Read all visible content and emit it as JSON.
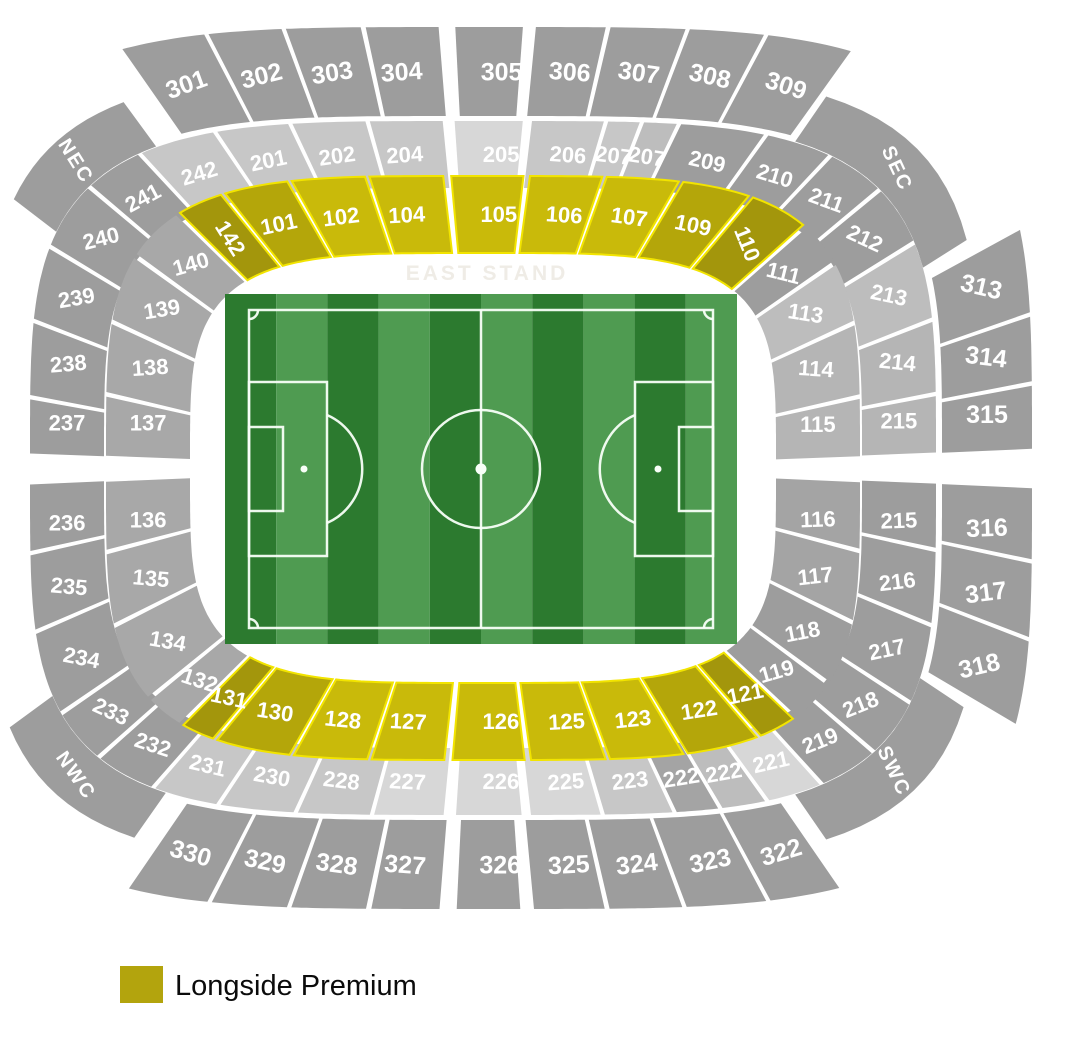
{
  "legend": {
    "label": "Longside Premium",
    "swatch": "#b3a40d"
  },
  "stand_label": "EAST STAND",
  "palette": {
    "Y1": "#c9ba0a",
    "Y2": "#b4a60a",
    "Y3": "#a3960c",
    "G": "#9d9d9d",
    "G2": "#a4a4a4",
    "L": "#c7c7c7",
    "LL": "#d7d7d7",
    "M": "#b5b5b5",
    "M2": "#a8a8a8",
    "M3": "#bdbdbd",
    "yellow_stroke": "#f2e400"
  },
  "pitch": {
    "x": 225,
    "y": 294,
    "w": 512,
    "h": 350,
    "stripes": 10,
    "stripe_dark": "#2c7a2f",
    "stripe_light": "#4f9b51",
    "line_color": "#f8fff8"
  },
  "sections": [
    {
      "label": "301",
      "ring": "r3",
      "color": "G",
      "rot": -20,
      "f": {
        "x": 150,
        "s": -1
      },
      "t": {
        "x": 229,
        "s": -1
      }
    },
    {
      "label": "302",
      "ring": "r3",
      "color": "G",
      "rot": -14,
      "t": {
        "x": 300,
        "s": -1
      }
    },
    {
      "label": "303",
      "ring": "r3",
      "color": "G",
      "rot": -9,
      "t": {
        "x": 373,
        "s": -1
      }
    },
    {
      "label": "304",
      "ring": "r3",
      "color": "G",
      "rot": -4,
      "t": {
        "x": 449,
        "s": -1
      }
    },
    {
      "label": "305",
      "ring": "r3",
      "color": "G",
      "rot": 0,
      "t": {
        "x": 526,
        "s": -1
      }
    },
    {
      "label": "306",
      "ring": "r3",
      "color": "G",
      "rot": 4,
      "t": {
        "x": 598,
        "s": -1
      }
    },
    {
      "label": "307",
      "ring": "r3",
      "color": "G",
      "rot": 8,
      "t": {
        "x": 671,
        "s": -1
      }
    },
    {
      "label": "308",
      "ring": "r3",
      "color": "G",
      "rot": 13,
      "t": {
        "x": 743,
        "s": -1
      }
    },
    {
      "label": "309",
      "ring": "r3",
      "color": "G",
      "rot": 18,
      "t": {
        "deg": -63
      }
    },
    {
      "label": "313",
      "ring": "r3",
      "color": "G",
      "rot": 13,
      "f": {
        "y": 252,
        "s": 1
      },
      "t": {
        "y": 330,
        "s": 1
      }
    },
    {
      "label": "314",
      "ring": "r3",
      "color": "G",
      "rot": 7,
      "t": {
        "y": 392,
        "s": 1
      }
    },
    {
      "label": "315",
      "ring": "r3",
      "color": "G",
      "rot": 0,
      "t": {
        "y": 472,
        "s": 1
      }
    },
    {
      "label": "316",
      "ring": "r3",
      "color": "G",
      "rot": -2,
      "t": {
        "y": 552,
        "s": 1
      }
    },
    {
      "label": "317",
      "ring": "r3",
      "color": "G",
      "rot": -7,
      "t": {
        "y": 622,
        "s": 1
      }
    },
    {
      "label": "318",
      "ring": "r3",
      "color": "G",
      "rot": -13,
      "t": {
        "y": 700,
        "s": 1
      }
    },
    {
      "label": "322",
      "ring": "r3",
      "color": "G",
      "rot": -17,
      "f": {
        "x": 812,
        "s": 1
      },
      "t": {
        "x": 745,
        "s": 1
      }
    },
    {
      "label": "323",
      "ring": "r3",
      "color": "G",
      "rot": -12,
      "t": {
        "x": 668,
        "s": 1
      }
    },
    {
      "label": "324",
      "ring": "r3",
      "color": "G",
      "rot": -7,
      "t": {
        "x": 597,
        "s": 1
      }
    },
    {
      "label": "325",
      "ring": "r3",
      "color": "G",
      "rot": -3,
      "t": {
        "x": 524,
        "s": 1
      }
    },
    {
      "label": "326",
      "ring": "r3",
      "color": "G",
      "rot": 0,
      "t": {
        "x": 450,
        "s": 1
      }
    },
    {
      "label": "327",
      "ring": "r3",
      "color": "G",
      "rot": 4,
      "t": {
        "x": 378,
        "s": 1
      }
    },
    {
      "label": "328",
      "ring": "r3",
      "color": "G",
      "rot": 8,
      "t": {
        "x": 305,
        "s": 1
      }
    },
    {
      "label": "329",
      "ring": "r3",
      "color": "G",
      "rot": 12,
      "t": {
        "x": 232,
        "s": 1
      }
    },
    {
      "label": "330",
      "ring": "r3",
      "color": "G",
      "rot": 16,
      "t": {
        "x": 156,
        "s": 1
      }
    },
    {
      "label": "NEC",
      "ring": "cn",
      "color": "G",
      "rot": 58,
      "corner": true,
      "f": {
        "deg": -153
      },
      "t": {
        "deg": -121
      }
    },
    {
      "label": "SEC",
      "ring": "cn",
      "color": "G",
      "rot": 65,
      "corner": true,
      "f": {
        "deg": -62
      },
      "t": {
        "deg": -19
      }
    },
    {
      "label": "SWC",
      "ring": "cn",
      "color": "G",
      "rot": 65,
      "corner": true,
      "f": {
        "deg": 21
      },
      "t": {
        "deg": 62
      }
    },
    {
      "label": "NWC",
      "ring": "cn",
      "color": "G",
      "rot": 55,
      "corner": true,
      "f": {
        "deg": 119
      },
      "t": {
        "deg": 155
      }
    },
    {
      "label": "242",
      "ring": "r2",
      "color": "L",
      "rot": -17,
      "f": {
        "deg": -125
      },
      "t": {
        "x": 237,
        "s": -1
      }
    },
    {
      "label": "201",
      "ring": "r2",
      "color": "L",
      "rot": -12,
      "t": {
        "x": 306,
        "s": -1
      }
    },
    {
      "label": "202",
      "ring": "r2",
      "color": "L",
      "rot": -8,
      "t": {
        "x": 377,
        "s": -1
      }
    },
    {
      "label": "204",
      "ring": "r2",
      "color": "L",
      "rot": -4,
      "t": {
        "x": 451,
        "s": -1
      }
    },
    {
      "label": "205",
      "ring": "r2",
      "color": "LL",
      "rot": 0,
      "t": {
        "x": 524,
        "s": -1
      }
    },
    {
      "label": "206",
      "ring": "r2",
      "color": "L",
      "rot": 4,
      "t": {
        "x": 596,
        "s": -1
      }
    },
    {
      "label": "207",
      "ring": "r2",
      "color": "L",
      "rot": 7,
      "t": {
        "x": 629,
        "s": -1
      }
    },
    {
      "label": "207",
      "ring": "r2",
      "color": "M3",
      "rot": 9,
      "t": {
        "x": 663,
        "s": -1
      }
    },
    {
      "label": "209",
      "ring": "r2",
      "color": "G",
      "rot": 13,
      "t": {
        "deg": -67
      }
    },
    {
      "label": "210",
      "ring": "r2",
      "color": "G",
      "rot": 17,
      "t": {
        "deg": -54
      }
    },
    {
      "label": "211",
      "ring": "r2",
      "color": "G",
      "rot": 20,
      "t": {
        "deg": -40
      }
    },
    {
      "label": "212",
      "ring": "r2",
      "color": "G",
      "rot": 25,
      "t": {
        "deg": -25
      }
    },
    {
      "label": "213",
      "ring": "r2",
      "color": "M3",
      "rot": 12,
      "t": {
        "y": 334,
        "s": 1
      }
    },
    {
      "label": "214",
      "ring": "r2",
      "color": "M",
      "rot": 6,
      "t": {
        "y": 401,
        "s": 1
      }
    },
    {
      "label": "215",
      "ring": "r2",
      "color": "M",
      "rot": 0,
      "t": {
        "y": 469,
        "s": 1
      }
    },
    {
      "label": "215",
      "ring": "r2",
      "color": "G",
      "rot": -2,
      "t": {
        "y": 542,
        "s": 1
      }
    },
    {
      "label": "216",
      "ring": "r2",
      "color": "G",
      "rot": -7,
      "t": {
        "y": 610,
        "s": 1
      }
    },
    {
      "label": "217",
      "ring": "r2",
      "color": "G",
      "rot": -12,
      "t": {
        "y": 680,
        "s": 1
      }
    },
    {
      "label": "218",
      "ring": "r2",
      "color": "G",
      "rot": -22,
      "t": {
        "deg": 42
      }
    },
    {
      "label": "219",
      "ring": "r2",
      "color": "G",
      "rot": -22,
      "t": {
        "deg": 56
      }
    },
    {
      "label": "221",
      "ring": "r2",
      "color": "LL",
      "rot": -13,
      "t": {
        "x": 744,
        "s": 1
      }
    },
    {
      "label": "222",
      "ring": "r2",
      "color": "M3",
      "rot": -10,
      "t": {
        "x": 701,
        "s": 1
      }
    },
    {
      "label": "222",
      "ring": "r2",
      "color": "G2",
      "rot": -9,
      "t": {
        "x": 659,
        "s": 1
      }
    },
    {
      "label": "223",
      "ring": "r2",
      "color": "L",
      "rot": -7,
      "t": {
        "x": 593,
        "s": 1
      }
    },
    {
      "label": "225",
      "ring": "r2",
      "color": "LL",
      "rot": -4,
      "t": {
        "x": 523,
        "s": 1
      }
    },
    {
      "label": "226",
      "ring": "r2",
      "color": "LL",
      "rot": 0,
      "t": {
        "x": 452,
        "s": 1
      }
    },
    {
      "label": "227",
      "ring": "r2",
      "color": "LL",
      "rot": 3,
      "t": {
        "x": 381,
        "s": 1
      }
    },
    {
      "label": "228",
      "ring": "r2",
      "color": "L",
      "rot": 7,
      "t": {
        "x": 311,
        "s": 1
      }
    },
    {
      "label": "230",
      "ring": "r2",
      "color": "L",
      "rot": 10,
      "t": {
        "x": 240,
        "s": 1
      }
    },
    {
      "label": "231",
      "ring": "r2",
      "color": "L",
      "rot": 13,
      "t": {
        "deg": 122
      }
    },
    {
      "label": "232",
      "ring": "r2",
      "color": "G",
      "rot": 18,
      "t": {
        "deg": 136
      }
    },
    {
      "label": "233",
      "ring": "r2",
      "color": "G",
      "rot": 25,
      "t": {
        "deg": 150
      }
    },
    {
      "label": "234",
      "ring": "r2",
      "color": "G",
      "rot": 11,
      "t": {
        "y": 616,
        "s": -1
      }
    },
    {
      "label": "235",
      "ring": "r2",
      "color": "G",
      "rot": 5,
      "t": {
        "y": 545,
        "s": -1
      }
    },
    {
      "label": "236",
      "ring": "r2",
      "color": "G",
      "rot": 0,
      "t": {
        "y": 473,
        "s": -1
      }
    },
    {
      "label": "237",
      "ring": "r2",
      "color": "G",
      "rot": 0,
      "t": {
        "y": 404,
        "s": -1
      }
    },
    {
      "label": "238",
      "ring": "r2",
      "color": "G",
      "rot": -5,
      "t": {
        "y": 335,
        "s": -1
      }
    },
    {
      "label": "239",
      "ring": "r2",
      "color": "G",
      "rot": -10,
      "t": {
        "y": 268,
        "s": -1
      }
    },
    {
      "label": "240",
      "ring": "r2",
      "color": "G",
      "rot": -14,
      "t": {
        "deg": -139
      }
    },
    {
      "label": "241",
      "ring": "r2",
      "color": "G",
      "rot": -28,
      "t": {
        "deg": -125
      }
    },
    {
      "label": "142",
      "ring": "r1",
      "color": "Y3",
      "rot": 58,
      "yellow": true,
      "f": {
        "x": 212,
        "s": -1
      },
      "t": {
        "x": 252,
        "s": -1
      }
    },
    {
      "label": "101",
      "ring": "r1",
      "color": "Y2",
      "rot": -12,
      "yellow": true,
      "t": {
        "x": 311,
        "s": -1
      }
    },
    {
      "label": "102",
      "ring": "r1",
      "color": "Y1",
      "rot": -7,
      "yellow": true,
      "t": {
        "x": 380,
        "s": -1
      }
    },
    {
      "label": "104",
      "ring": "r1",
      "color": "Y1",
      "rot": -3,
      "yellow": true,
      "t": {
        "x": 451,
        "s": -1
      }
    },
    {
      "label": "105",
      "ring": "r1",
      "color": "Y1",
      "rot": 0,
      "yellow": true,
      "t": {
        "x": 522,
        "s": -1
      }
    },
    {
      "label": "106",
      "ring": "r1",
      "color": "Y1",
      "rot": 4,
      "yellow": true,
      "t": {
        "x": 591,
        "s": -1
      }
    },
    {
      "label": "107",
      "ring": "r1",
      "color": "Y1",
      "rot": 8,
      "yellow": true,
      "t": {
        "x": 659,
        "s": -1
      }
    },
    {
      "label": "109",
      "ring": "r1",
      "color": "Y2",
      "rot": 12,
      "yellow": true,
      "t": {
        "x": 721,
        "s": -1
      }
    },
    {
      "label": "110",
      "ring": "r1",
      "color": "Y3",
      "rot": 68,
      "yellow": true,
      "t": {
        "x": 769,
        "s": -1
      }
    },
    {
      "label": "111",
      "ring": "r1",
      "color": "G",
      "rot": 14,
      "t": {
        "y": 290,
        "s": 1
      }
    },
    {
      "label": "113",
      "ring": "r1",
      "color": "M3",
      "rot": 9,
      "t": {
        "y": 342,
        "s": 1
      }
    },
    {
      "label": "114",
      "ring": "r1",
      "color": "M",
      "rot": 4,
      "t": {
        "y": 406,
        "s": 1
      }
    },
    {
      "label": "115",
      "ring": "r1",
      "color": "M",
      "rot": 0,
      "t": {
        "y": 473,
        "s": 1
      }
    },
    {
      "label": "116",
      "ring": "r1",
      "color": "G2",
      "rot": -2,
      "t": {
        "y": 540,
        "s": 1
      }
    },
    {
      "label": "117",
      "ring": "r1",
      "color": "G2",
      "rot": -6,
      "t": {
        "y": 602,
        "s": 1
      }
    },
    {
      "label": "118",
      "ring": "r1",
      "color": "G",
      "rot": -11,
      "t": {
        "y": 655,
        "s": 1
      }
    },
    {
      "label": "119",
      "ring": "r1",
      "color": "G",
      "rot": -16,
      "t": {
        "x": 760,
        "s": 1
      }
    },
    {
      "label": "121",
      "ring": "r1",
      "color": "Y3",
      "rot": -12,
      "yellow": true,
      "t": {
        "x": 728,
        "s": 1
      }
    },
    {
      "label": "122",
      "ring": "r1",
      "color": "Y2",
      "rot": -9,
      "yellow": true,
      "t": {
        "x": 663,
        "s": 1
      }
    },
    {
      "label": "123",
      "ring": "r1",
      "color": "Y1",
      "rot": -6,
      "yellow": true,
      "t": {
        "x": 594,
        "s": 1
      }
    },
    {
      "label": "125",
      "ring": "r1",
      "color": "Y1",
      "rot": -3,
      "yellow": true,
      "t": {
        "x": 523,
        "s": 1
      }
    },
    {
      "label": "126",
      "ring": "r1",
      "color": "Y1",
      "rot": 0,
      "yellow": true,
      "t": {
        "x": 452,
        "s": 1
      }
    },
    {
      "label": "127",
      "ring": "r1",
      "color": "Y1",
      "rot": 3,
      "yellow": true,
      "t": {
        "x": 382,
        "s": 1
      }
    },
    {
      "label": "128",
      "ring": "r1",
      "color": "Y1",
      "rot": 6,
      "yellow": true,
      "t": {
        "x": 313,
        "s": 1
      }
    },
    {
      "label": "130",
      "ring": "r1",
      "color": "Y2",
      "rot": 9,
      "yellow": true,
      "t": {
        "x": 245,
        "s": 1
      }
    },
    {
      "label": "131",
      "ring": "r1",
      "color": "Y3",
      "rot": 12,
      "yellow": true,
      "t": {
        "x": 215,
        "s": 1
      }
    },
    {
      "label": "132",
      "ring": "r1",
      "color": "M2",
      "rot": 18,
      "t": {
        "y": 668,
        "s": -1
      }
    },
    {
      "label": "134",
      "ring": "r1",
      "color": "M2",
      "rot": 10,
      "t": {
        "y": 605,
        "s": -1
      }
    },
    {
      "label": "135",
      "ring": "r1",
      "color": "M2",
      "rot": 5,
      "t": {
        "y": 541,
        "s": -1
      }
    },
    {
      "label": "136",
      "ring": "r1",
      "color": "M2",
      "rot": 0,
      "t": {
        "y": 472,
        "s": -1
      }
    },
    {
      "label": "137",
      "ring": "r1",
      "color": "M2",
      "rot": 0,
      "t": {
        "y": 404,
        "s": -1
      }
    },
    {
      "label": "138",
      "ring": "r1",
      "color": "M2",
      "rot": -4,
      "t": {
        "y": 341,
        "s": -1
      }
    },
    {
      "label": "139",
      "ring": "r1",
      "color": "M2",
      "rot": -9,
      "t": {
        "y": 284,
        "s": -1
      }
    },
    {
      "label": "140",
      "ring": "r1",
      "color": "M2",
      "rot": -16,
      "t": {
        "x": 212,
        "s": -1
      }
    }
  ]
}
